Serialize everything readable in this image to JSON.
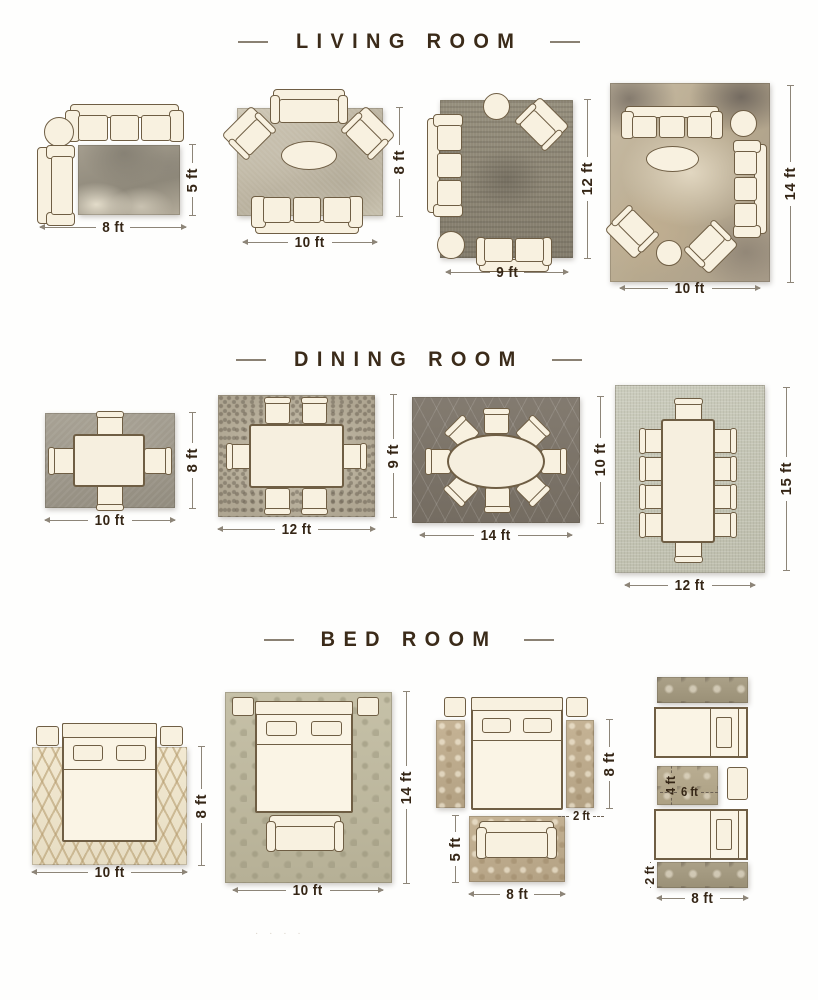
{
  "sections": [
    {
      "title": "LIVING ROOM",
      "layouts": [
        {
          "width": "8 ft",
          "height": "5 ft"
        },
        {
          "width": "10 ft",
          "height": "8 ft"
        },
        {
          "width": "9 ft",
          "height": "12 ft"
        },
        {
          "width": "10 ft",
          "height": "14 ft"
        }
      ]
    },
    {
      "title": "DINING ROOM",
      "layouts": [
        {
          "width": "10 ft",
          "height": "8 ft"
        },
        {
          "width": "12 ft",
          "height": "9 ft"
        },
        {
          "width": "14 ft",
          "height": "10 ft"
        },
        {
          "width": "12 ft",
          "height": "15 ft"
        }
      ]
    },
    {
      "title": "BED ROOM",
      "layouts": [
        {
          "width": "10 ft",
          "height": "8 ft"
        },
        {
          "width": "10 ft",
          "height": "14 ft"
        },
        {
          "width": "8 ft",
          "height": "8 ft",
          "runner_width": "2 ft",
          "foot_rug_height": "5 ft"
        },
        {
          "width": "8 ft",
          "mid_rug_width": "6 ft",
          "mid_rug_height": "4 ft",
          "runner_height": "2 ft"
        }
      ]
    }
  ],
  "watermark": "· ·  · ·",
  "colors": {
    "title_text": "#3b2b19",
    "dimension_text": "#352616",
    "dimension_line": "#8d8578",
    "furniture_fill": "#f8f1e0",
    "furniture_outline": "#6f5e44"
  }
}
